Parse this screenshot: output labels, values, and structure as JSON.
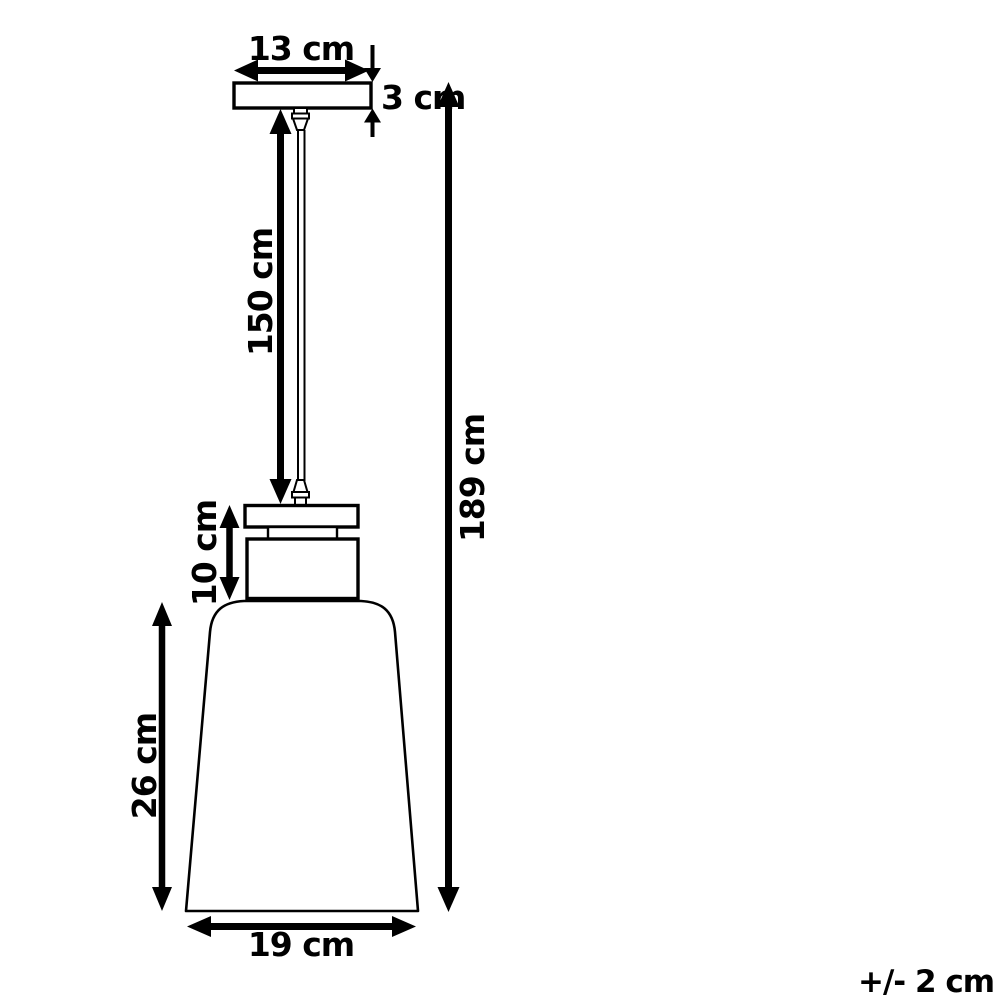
{
  "diagram": {
    "title": "Pendant lamp dimension drawing",
    "unit": "cm",
    "colors": {
      "line": "#000000",
      "background": "#ffffff"
    },
    "labels": {
      "canopy_width": "13 cm",
      "canopy_height": "3 cm",
      "cord_length": "150 cm",
      "total_height": "189 cm",
      "holder_height": "10 cm",
      "shade_height": "26 cm",
      "shade_width": "19 cm",
      "tolerance": "+/- 2 cm"
    },
    "values": {
      "canopy_width_cm": 13,
      "canopy_height_cm": 3,
      "cord_length_cm": 150,
      "total_height_cm": 189,
      "holder_height_cm": 10,
      "shade_height_cm": 26,
      "shade_width_cm": 19,
      "tolerance_cm": 2
    }
  }
}
